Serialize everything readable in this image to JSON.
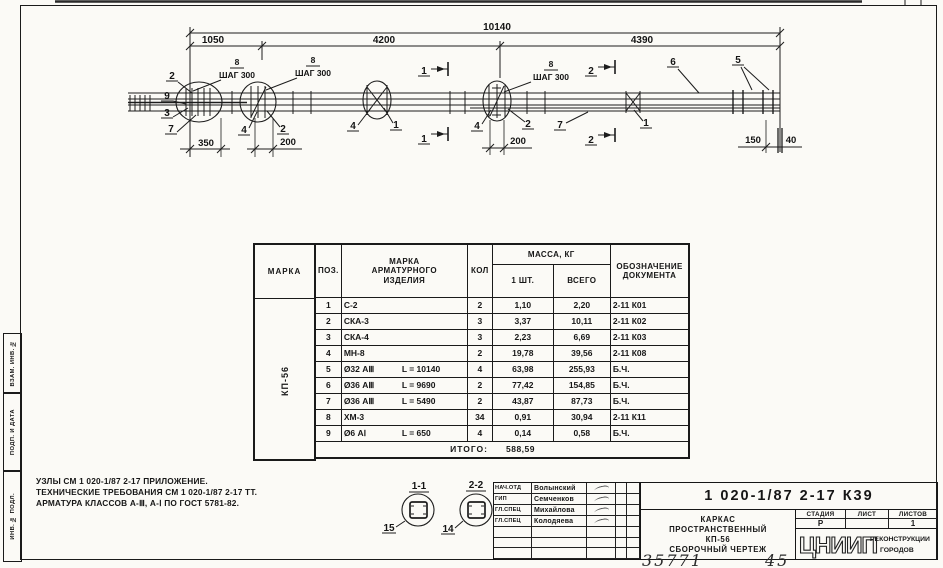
{
  "sheet": {
    "stamps": [
      "ВЗАМ. ИНВ. №",
      "ПОДП. И ДАТА",
      "ИНВ. № ПОДЛ."
    ],
    "handwritten": "35771",
    "handwritten2": "45"
  },
  "drawing": {
    "dim_total": "10140",
    "dim_seg1": "1050",
    "dim_seg2": "4200",
    "dim_seg3": "4390",
    "dim_350": "350",
    "dim_200a": "200",
    "dim_200b": "200",
    "dim_150": "150",
    "dim_40": "40",
    "step1_pos": "8",
    "step1_label": "ШАГ 300",
    "step2_pos": "8",
    "step2_label": "ШАГ 300",
    "step3_pos": "8",
    "step3_label": "ШАГ 300",
    "sec1": "1",
    "sec2": "2",
    "callouts": {
      "p2a": "2",
      "p9": "9",
      "p3": "3",
      "p7a": "7",
      "p4a": "4",
      "p2b": "2",
      "p4b": "4",
      "p1a": "1",
      "p4c": "4",
      "p2c": "2",
      "p7b": "7",
      "p1b": "1",
      "p6": "6",
      "p5": "5"
    },
    "details": {
      "d1_label": "1-1",
      "d1_pos": "15",
      "d2_label": "2-2",
      "d2_pos": "14"
    }
  },
  "notes": {
    "line1": "УЗЛЫ СМ 1 020-1/87 2-17 ПРИЛОЖЕНИЕ.",
    "line2": "ТЕХНИЧЕСКИЕ ТРЕБОВАНИЯ СМ 1 020-1/87 2-17 ТТ.",
    "line3": "АРМАТУРА КЛАССОВ А-Ⅲ, А-Ⅰ ПО ГОСТ 5781-82."
  },
  "table": {
    "headers": {
      "marka": "МАРКА",
      "poz": "ПОЗ.",
      "item": "МАРКА\nАРМАТУРНОГО\nИЗДЕЛИЯ",
      "qty": "КОЛ",
      "mass": "МАССА, КГ",
      "one": "1 ШТ.",
      "total": "ВСЕГО",
      "doc": "ОБОЗНАЧЕНИЕ\nДОКУМЕНТА"
    },
    "marka_value": "КП-56",
    "rows": [
      {
        "poz": "1",
        "mark": "С-2",
        "len": "",
        "qty": "2",
        "one": "1,10",
        "total": "2,20",
        "doc": "2-11  К01"
      },
      {
        "poz": "2",
        "mark": "СКА-3",
        "len": "",
        "qty": "3",
        "one": "3,37",
        "total": "10,11",
        "doc": "2-11  К02"
      },
      {
        "poz": "3",
        "mark": "СКА-4",
        "len": "",
        "qty": "3",
        "one": "2,23",
        "total": "6,69",
        "doc": "2-11  К03"
      },
      {
        "poz": "4",
        "mark": "МН-8",
        "len": "",
        "qty": "2",
        "one": "19,78",
        "total": "39,56",
        "doc": "2-11  К08"
      },
      {
        "poz": "5",
        "mark": "Ø32 АⅢ",
        "len": "L = 10140",
        "qty": "4",
        "one": "63,98",
        "total": "255,93",
        "doc": "Б.Ч."
      },
      {
        "poz": "6",
        "mark": "Ø36 АⅢ",
        "len": "L = 9690",
        "qty": "2",
        "one": "77,42",
        "total": "154,85",
        "doc": "Б.Ч."
      },
      {
        "poz": "7",
        "mark": "Ø36 АⅢ",
        "len": "L = 5490",
        "qty": "2",
        "one": "43,87",
        "total": "87,73",
        "doc": "Б.Ч."
      },
      {
        "poz": "8",
        "mark": "ХМ-3",
        "len": "",
        "qty": "34",
        "one": "0,91",
        "total": "30,94",
        "doc": "2-11  К11"
      },
      {
        "poz": "9",
        "mark": "Ø6 АⅠ",
        "len": "L = 650",
        "qty": "4",
        "one": "0,14",
        "total": "0,58",
        "doc": "Б.Ч."
      }
    ],
    "total_label": "ИТОГО:",
    "total_value": "588,59"
  },
  "titleblock": {
    "doc_number": "1 020-1/87 2-17 К39",
    "signatures": [
      {
        "role": "НАЧ.ОТД",
        "name": "Волынский"
      },
      {
        "role": "ГИП",
        "name": "Семченков"
      },
      {
        "role": "ГЛ.СПЕЦ",
        "name": "Михайлова"
      },
      {
        "role": "ГЛ.СПЕЦ",
        "name": "Колодяева"
      }
    ],
    "title_line1": "КАРКАС",
    "title_line2": "ПРОСТРАНСТВЕННЫЙ",
    "title_line3": "КП-56",
    "title_line4": "СБОРОЧНЫЙ ЧЕРТЕЖ",
    "stage_header": "СТАДИЯ",
    "sheet_header": "ЛИСТ",
    "sheets_header": "ЛИСТОВ",
    "stage": "Р",
    "sheet": "",
    "sheets": "1",
    "org": "ЦНИИП",
    "org_sub1": "РЕКОНСТРУКЦИИ",
    "org_sub2": "ГОРОДОВ"
  }
}
